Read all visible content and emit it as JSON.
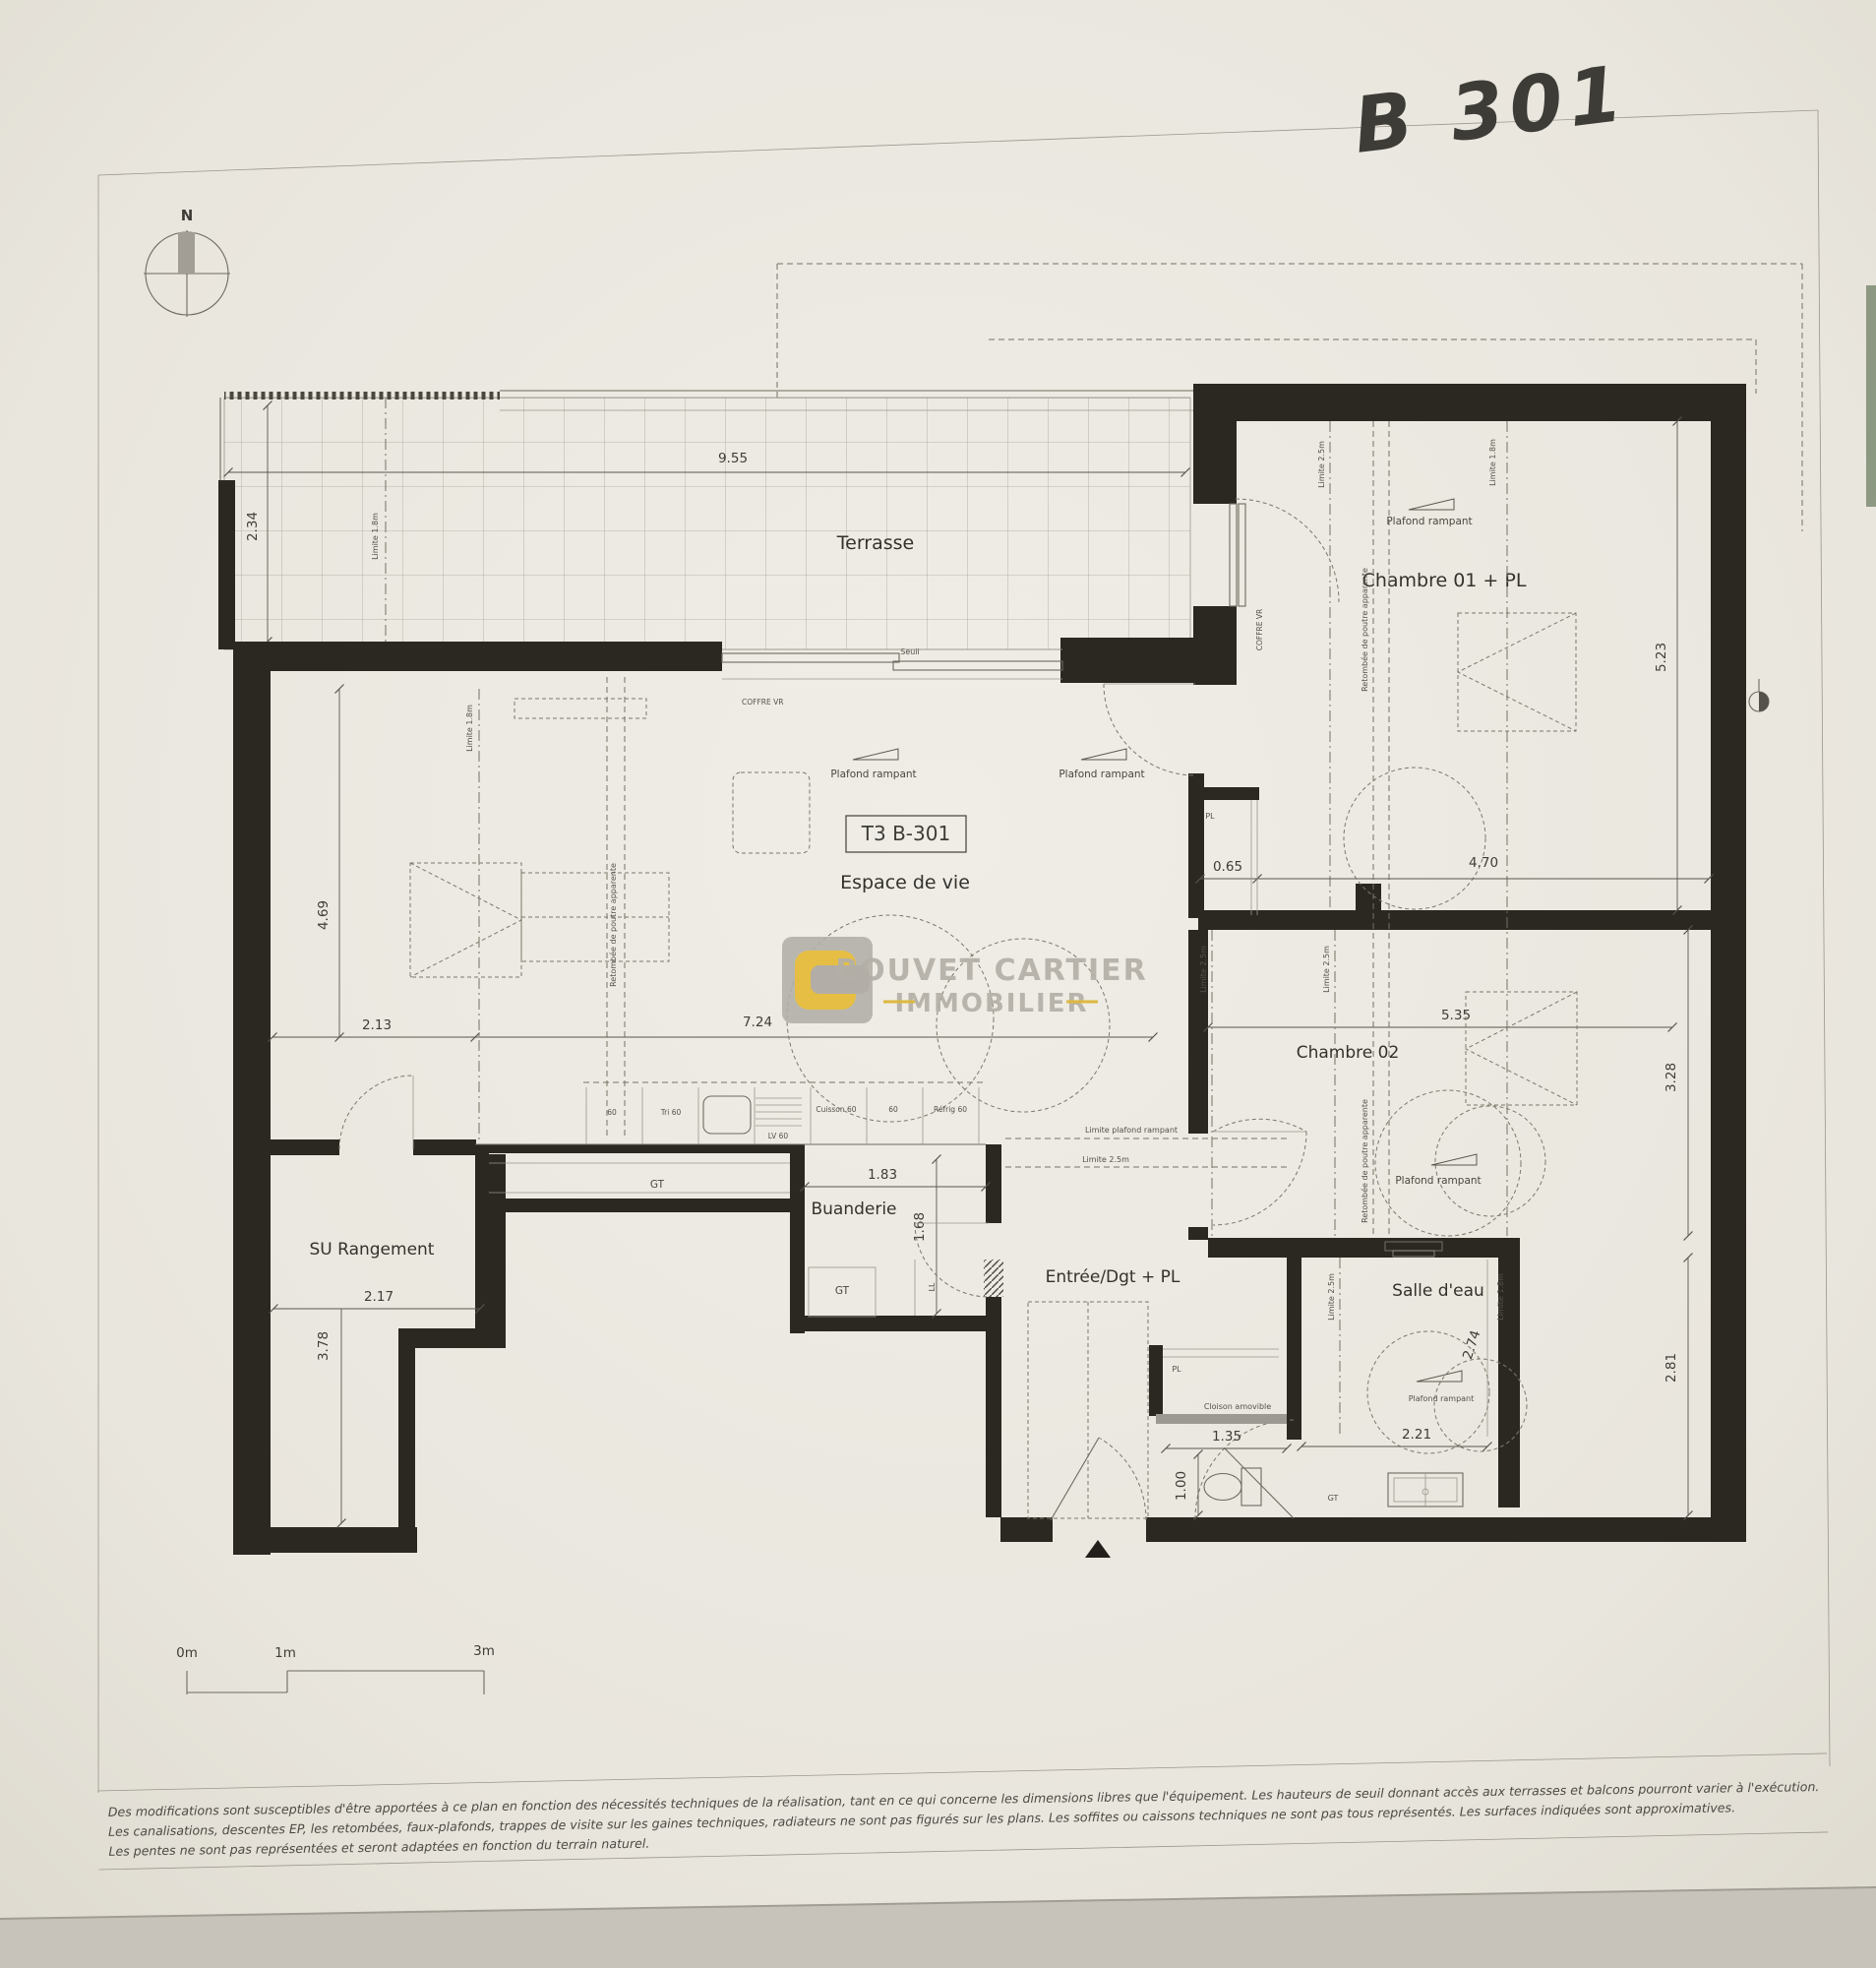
{
  "annotation": {
    "handwritten_label": "B 301"
  },
  "compass": {
    "north": "N"
  },
  "unit_box": {
    "label": "T3 B-301"
  },
  "rooms": {
    "terrasse": {
      "name": "Terrasse",
      "width": "9.55",
      "depth": "2.34"
    },
    "chambre01": {
      "name": "Chambre 01 + PL",
      "height": "5.23",
      "width": "4.70",
      "pl_width": "0.65",
      "pl": "PL"
    },
    "espace_de_vie": {
      "name": "Espace de vie",
      "height": "4.69",
      "seg1": "2.13",
      "seg2": "7.24"
    },
    "chambre02": {
      "name": "Chambre 02",
      "width": "5.35",
      "height_upper": "3.28",
      "height_lower": "2.81"
    },
    "buanderie": {
      "name": "Buanderie",
      "width": "1.83",
      "depth": "1.68",
      "ll": "LL"
    },
    "entree": {
      "name": "Entrée/Dgt + PL",
      "pl": "PL",
      "wc_width": "1.35",
      "wc_depth": "1.00",
      "cloison": "Cloison amovible"
    },
    "salle_deau": {
      "name": "Salle d'eau",
      "depth": "2.74",
      "width": "2.21"
    },
    "rangement": {
      "name": "SU Rangement",
      "width": "2.17",
      "depth": "3.78"
    }
  },
  "annotations": {
    "plafond_rampant": "Plafond rampant",
    "limite_plafond_rampant": "Limite plafond rampant",
    "limite_25": "Limite 2.5m",
    "limite_18": "Limite 1.8m",
    "retombee": "Retombée de poutre apparente",
    "coffre_vr": "COFFRE VR",
    "gt": "GT",
    "seuil": "Seuil"
  },
  "kitchen": {
    "m60": "60",
    "tri": "Tri 60",
    "lv": "LV 60",
    "cuisson": "Cuisson 60",
    "refrig": "Réfrig 60"
  },
  "watermark": {
    "line1": "BOUVET CARTIER",
    "line2": "IMMOBILIER"
  },
  "scale_bar": {
    "m0": "0m",
    "m1": "1m",
    "m3": "3m"
  },
  "footer": {
    "lines": [
      "Des modifications sont susceptibles d'être apportées à ce plan en fonction des nécessités techniques de la réalisation, tant en ce qui concerne les dimensions libres que l'équipement. Les hauteurs de seuil donnant accès aux terrasses et balcons pourront varier à l'exécution.",
      "Les canalisations, descentes EP, les retombées, faux-plafonds, trappes de visite sur les gaines techniques, radiateurs ne sont pas figurés sur les plans. Les soffites ou caissons techniques ne sont pas tous représentés. Les surfaces indiquées sont approximatives.",
      "Les pentes ne sont pas représentées et seront adaptées en fonction du terrain naturel."
    ]
  }
}
